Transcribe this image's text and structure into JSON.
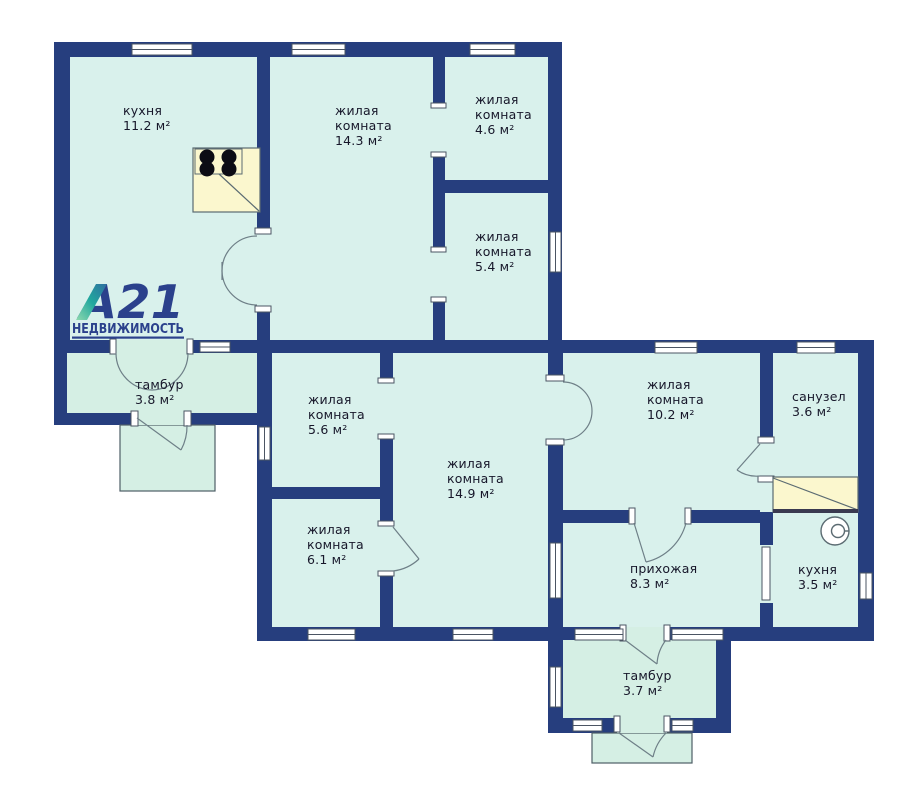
{
  "logo": {
    "brand": "А21",
    "subtitle": "НЕДВИЖИМОСТЬ"
  },
  "rooms": [
    {
      "id": "kitchen-main",
      "lines": [
        "кухня",
        "11.2 м²"
      ]
    },
    {
      "id": "living-room-14-3",
      "lines": [
        "жилая",
        "комната",
        "14.3 м²"
      ]
    },
    {
      "id": "living-room-4-6",
      "lines": [
        "жилая",
        "комната",
        "4.6 м²"
      ]
    },
    {
      "id": "living-room-5-4",
      "lines": [
        "жилая",
        "комната",
        "5.4 м²"
      ]
    },
    {
      "id": "tambour-3-8",
      "lines": [
        "тамбур",
        "3.8 м²"
      ]
    },
    {
      "id": "living-room-5-6",
      "lines": [
        "жилая",
        "комната",
        "5.6 м²"
      ]
    },
    {
      "id": "living-room-6-1",
      "lines": [
        "жилая",
        "комната",
        "6.1 м²"
      ]
    },
    {
      "id": "living-room-14-9",
      "lines": [
        "жилая",
        "комната",
        "14.9 м²"
      ]
    },
    {
      "id": "living-room-10-2",
      "lines": [
        "жилая",
        "комната",
        "10.2 м²"
      ]
    },
    {
      "id": "bathroom-3-6",
      "lines": [
        "санузел",
        "3.6 м²"
      ]
    },
    {
      "id": "hallway-8-3",
      "lines": [
        "прихожая",
        "8.3 м²"
      ]
    },
    {
      "id": "kitchen-3-5",
      "lines": [
        "кухня",
        "3.5 м²"
      ]
    },
    {
      "id": "tambour-3-7",
      "lines": [
        "тамбур",
        "3.7 м²"
      ]
    }
  ],
  "colors": {
    "wall": "#263e7e",
    "room_fill": "#d9f1ec",
    "vestibule_fill": "#d5efe4",
    "counter_yellow": "#fbf7ce",
    "brand_navy": "#2b418c",
    "brand_teal": "#1fa79e",
    "label_text": "#17172a"
  }
}
